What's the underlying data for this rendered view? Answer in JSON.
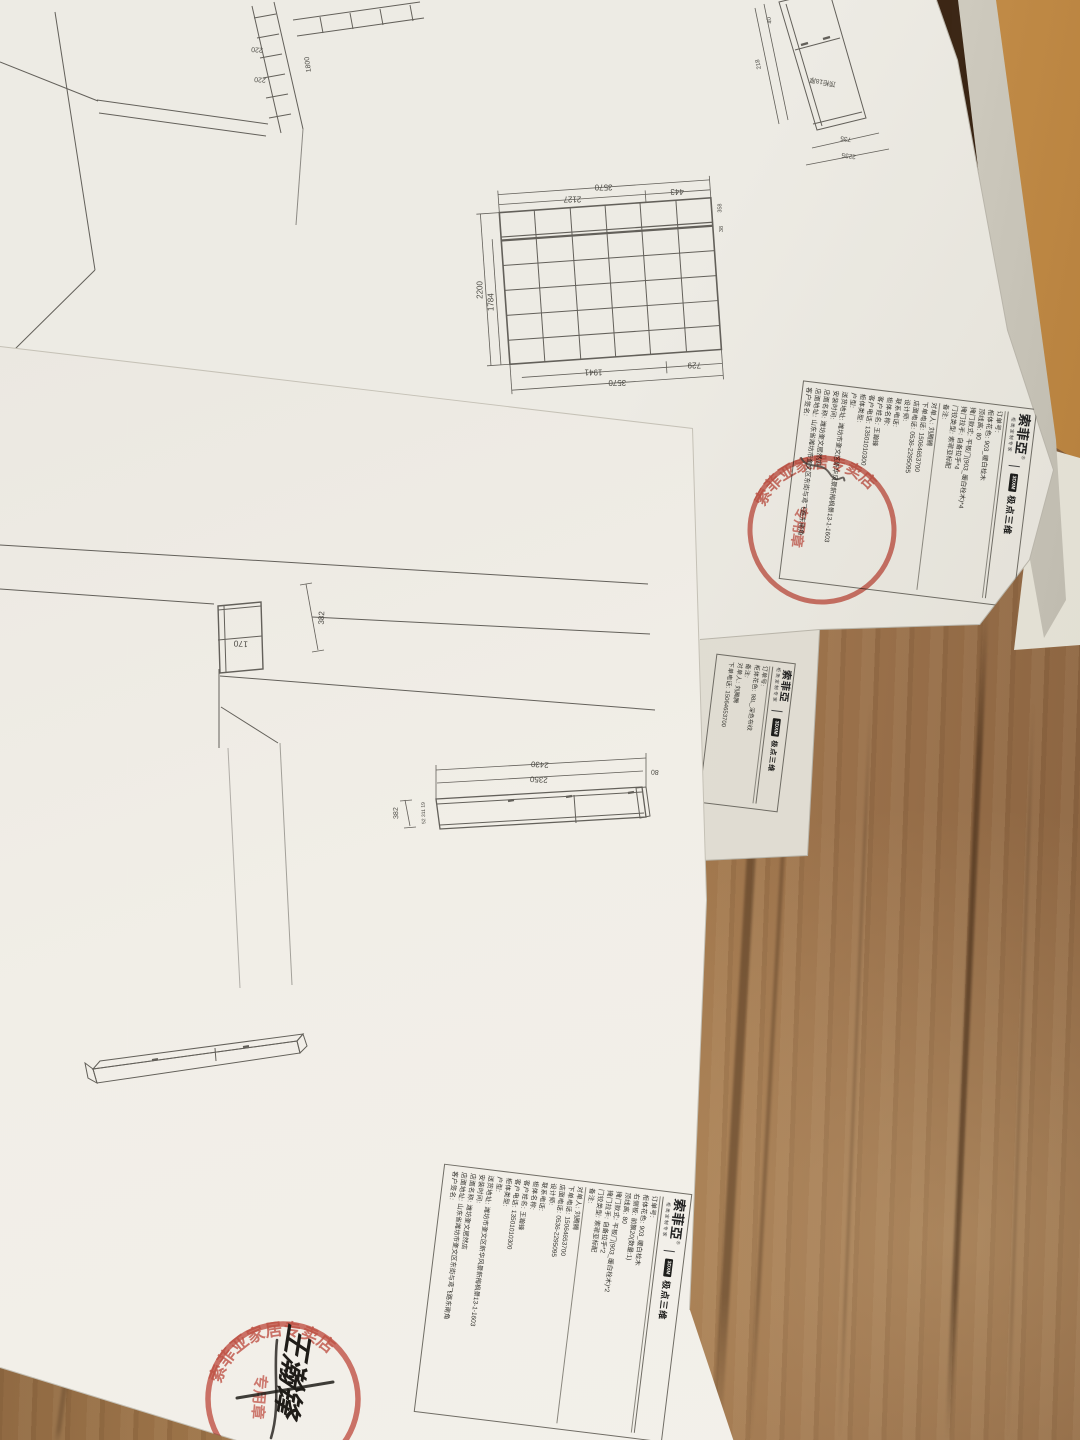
{
  "scene": {
    "colors": {
      "wood_base": "#9a7046",
      "wood_dark": "#6f4a2b",
      "wood_light": "#c09a63",
      "paper": "#eceae3",
      "envelope": "#b9813f",
      "line_ink": "#63605a",
      "text_ink": "#35342f",
      "stamp_red": "#c0392b"
    }
  },
  "brand": {
    "name": "索菲亞",
    "registered": "®",
    "subtitle": "柜类定制专家",
    "divider": "|",
    "software_logo": "3DXM",
    "software_name": "极点三维"
  },
  "paper_top": {
    "fields_product": [
      {
        "label": "订单号:",
        "value": ""
      },
      {
        "label": "柜体花色:",
        "value": "903_暖白栓木"
      },
      {
        "label": "顶线高:",
        "value": "80"
      },
      {
        "label": "掩门款式:",
        "value": "平板门(903_暖白栓木)*4"
      },
      {
        "label": "掩门拉手:",
        "value": "自备拉手*4"
      },
      {
        "label": "门铰类型:",
        "value": "索菲亚标配"
      },
      {
        "label": "备注:",
        "value": ""
      }
    ],
    "fields_order": [
      {
        "label": "对单人:",
        "value": "刘腾腾"
      },
      {
        "label": "下单电话:",
        "value": "15064653700"
      },
      {
        "label": "店面电话:",
        "value": "0536-2295095"
      },
      {
        "label": "设计师:",
        "value": ""
      },
      {
        "label": "联系电话:",
        "value": ""
      },
      {
        "label": "柜体名称:",
        "value": ""
      },
      {
        "label": "客户姓名:",
        "value": "王瀚锋"
      },
      {
        "label": "客户电话:",
        "value": "13501010300"
      },
      {
        "label": "柜体类型:",
        "value": ""
      },
      {
        "label": "户型:",
        "value": ""
      },
      {
        "label": "送货地址:",
        "value": "潍坊市奎文区新华风景新梅枫景13-1-1603"
      },
      {
        "label": "安装时间:",
        "value": ""
      },
      {
        "label": "店面名称:",
        "value": "潍坊奎文居然店"
      },
      {
        "label": "店面地址:",
        "value": "山东省潍坊市奎文区东街与鸢飞路东南角"
      },
      {
        "label": "客户签名:",
        "value": ""
      }
    ],
    "wardrobe_grid": {
      "dim_top_total": "3570",
      "dim_top_left": "2127",
      "dim_top_right": "443",
      "dim_left_outer": "2200",
      "dim_left_inner": "1784",
      "dim_bottom_left": "1941",
      "dim_bottom_right": "729",
      "dim_bottom_total": "3570",
      "dim_side_a": "358",
      "dim_side_b": "38"
    },
    "top_cabinet": {
      "label": "顶柜18厚",
      "dim_length": "2235",
      "dim_end": "735",
      "dim_side": "218",
      "dim_depth": "40"
    },
    "room_sketch": {
      "dim_a": "220",
      "dim_b": "220",
      "dim_c": "1800"
    },
    "stamp": {
      "arc_text": "索菲亚家居专卖店",
      "center_text": "专用章"
    }
  },
  "paper_under": {
    "fields": [
      {
        "label": "订单号:",
        "value": ""
      },
      {
        "label": "柜体花色:",
        "value": "98L_深色布纹"
      },
      {
        "label": "备注:",
        "value": ""
      },
      {
        "label": "对单人:",
        "value": "刘腾腾"
      },
      {
        "label": "下单电话:",
        "value": "15064653700"
      }
    ]
  },
  "paper_bottom": {
    "fields_product": [
      {
        "label": "订单号:",
        "value": ""
      },
      {
        "label": "柜体花色:",
        "value": "903_暖白栓木"
      },
      {
        "label": "右侧板:",
        "value": "前飘20(数量:1)"
      },
      {
        "label": "顶线高:",
        "value": "80"
      },
      {
        "label": "掩门款式:",
        "value": "平板门(903_暖白栓木)*2"
      },
      {
        "label": "掩门拉手:",
        "value": "自备拉手*2"
      },
      {
        "label": "门铰类型:",
        "value": "索菲亚标配"
      },
      {
        "label": "备注:",
        "value": ""
      }
    ],
    "fields_order": [
      {
        "label": "对单人:",
        "value": "刘腾腾"
      },
      {
        "label": "下单电话:",
        "value": "15064653700"
      },
      {
        "label": "店面电话:",
        "value": "0536-2295095"
      },
      {
        "label": "设计师:",
        "value": ""
      },
      {
        "label": "联系电话:",
        "value": ""
      },
      {
        "label": "柜体名称:",
        "value": ""
      },
      {
        "label": "客户姓名:",
        "value": "王瀚锋"
      },
      {
        "label": "客户电话:",
        "value": "13501010300"
      },
      {
        "label": "柜体类型:",
        "value": ""
      },
      {
        "label": "户型:",
        "value": ""
      },
      {
        "label": "送货地址:",
        "value": "潍坊市奎文区新华风景新梅枫景13-1-1603"
      },
      {
        "label": "安装时间:",
        "value": ""
      },
      {
        "label": "店面名称:",
        "value": "潍坊奎文居然店"
      },
      {
        "label": "店面地址:",
        "value": "山东省潍坊市奎文区东街与鸢飞路东南角"
      },
      {
        "label": "客户签名:",
        "value": ""
      }
    ],
    "tv_cabinet": {
      "dim_top": "2430",
      "dim_inner": "2350",
      "dim_left": "382",
      "dim_right": "80",
      "dim_small": "52 311 19"
    },
    "detail": {
      "cab_width": "170",
      "dim": "382"
    },
    "stamp": {
      "arc_text": "索菲亚家居专卖店",
      "center_text": "专用章"
    },
    "signature": "王瀚锋"
  }
}
